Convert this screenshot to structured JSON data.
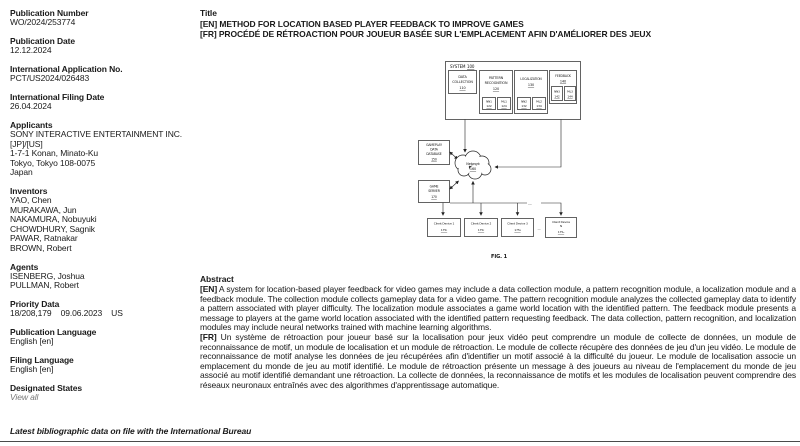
{
  "sidebar": {
    "fields": [
      {
        "label": "Publication Number",
        "value": "WO/2024/253774"
      },
      {
        "label": "Publication Date",
        "value": "12.12.2024"
      },
      {
        "label": "International Application No.",
        "value": "PCT/US2024/026483"
      },
      {
        "label": "International Filing Date",
        "value": "26.04.2024"
      },
      {
        "label": "Applicants",
        "value": "SONY INTERACTIVE ENTERTAINMENT INC.\n[JP]/[US]\n1-7-1 Konan, Minato-Ku\nTokyo, Tokyo 108-0075\nJapan"
      },
      {
        "label": "Inventors",
        "value": "YAO, Chen\nMURAKAWA, Jun\nNAKAMURA, Nobuyuki\nCHOWDHURY, Sagnik\nPAWAR, Ratnakar\nBROWN, Robert"
      },
      {
        "label": "Agents",
        "value": "ISENBERG, Joshua\nPULLMAN, Robert"
      },
      {
        "label": "Priority Data",
        "value": "18/208,179    09.06.2023    US"
      },
      {
        "label": "Publication Language",
        "value": "English [en]"
      },
      {
        "label": "Filing Language",
        "value": "English [en]"
      },
      {
        "label": "Designated States",
        "value": "View all"
      }
    ]
  },
  "title_block": {
    "heading": "Title",
    "en_tag": "[EN]",
    "en_text": "METHOD FOR LOCATION BASED PLAYER FEEDBACK TO IMPROVE GAMES",
    "fr_tag": "[FR]",
    "fr_text": "PROCÉDÉ DE RÉTROACTION POUR JOUEUR BASÉE SUR L'EMPLACEMENT AFIN D'AMÉLIORER DES JEUX"
  },
  "abstract": {
    "heading": "Abstract",
    "en_tag": "[EN]",
    "en_text": "A system for location-based player feedback for video games may include a data collection module, a pattern recognition module, a localization module and a feedback module. The collection module collects gameplay data for a video game. The pattern recognition module analyzes the collected gameplay data to identify a pattern associated with player difficulty. The localization module associates a game world location with the identified pattern. The feedback module presents a message to players at the game world location associated with the identified pattern requesting feedback. The data collection, pattern recognition, and localization modules may include neural networks trained with machine learning algorithms.",
    "fr_tag": "[FR]",
    "fr_text": "Un système de rétroaction pour joueur basé sur la localisation pour jeux vidéo peut comprendre un module de collecte de données, un module de reconnaissance de motif, un module de localisation et un module de rétroaction. Le module de collecte récupère des données de jeu d'un jeu vidéo. Le module de reconnaissance de motif analyse les données de jeu récupérées afin d'identifier un motif associé à la difficulté du joueur. Le module de localisation associe un emplacement du monde de jeu au motif identifié. Le module de rétroaction présente un message à des joueurs au niveau de l'emplacement du monde de jeu associé au motif identifié demandant une rétroaction. La collecte de données, la reconnaissance de motifs et les modules de localisation peuvent comprendre des réseaux neuronaux entraînés avec des algorithmes d'apprentissage automatique."
  },
  "figure": {
    "system": {
      "label": "SYSTEM",
      "num": "100"
    },
    "data_collection": {
      "line1": "DATA",
      "line2": "COLLECTION",
      "num": "110"
    },
    "pattern_recognition": {
      "line1": "PATTERN",
      "line2": "RECOGNITION",
      "num": "120",
      "nn_label": "NN1",
      "nn_num": "122",
      "ml_label": "ML1",
      "ml_num": "124"
    },
    "localization": {
      "line1": "LOCALIZATION",
      "num": "130",
      "nn_label": "NN2",
      "nn_num": "132",
      "ml_label": "ML2",
      "ml_num": "134"
    },
    "feedback": {
      "line1": "FEEDBACK",
      "num": "140",
      "nn_label": "NN3",
      "nn_num": "142",
      "ml_label": "ML3",
      "ml_num": "144"
    },
    "database": {
      "line1": "GAMEPLAY",
      "line2": "DATA",
      "line3": "DATABASE",
      "num": "150"
    },
    "network": {
      "line1": "Network",
      "num": "160"
    },
    "game_server": {
      "line1": "GAME",
      "line2": "SERVER",
      "num": "170"
    },
    "client1": {
      "line1": "Client Device 1",
      "num": "175₁"
    },
    "client2": {
      "line1": "Client Device 2",
      "num": "175₂"
    },
    "client3": {
      "line1": "Client Device 3",
      "num": "175₃"
    },
    "clientN": {
      "line1": "Client Device",
      "line2": "N",
      "num": "175ₙ"
    },
    "bus_dots": "....",
    "row_dots": "...",
    "caption": "FIG. 1"
  },
  "footer": {
    "note": "Latest bibliographic data on file with the International Bureau"
  }
}
